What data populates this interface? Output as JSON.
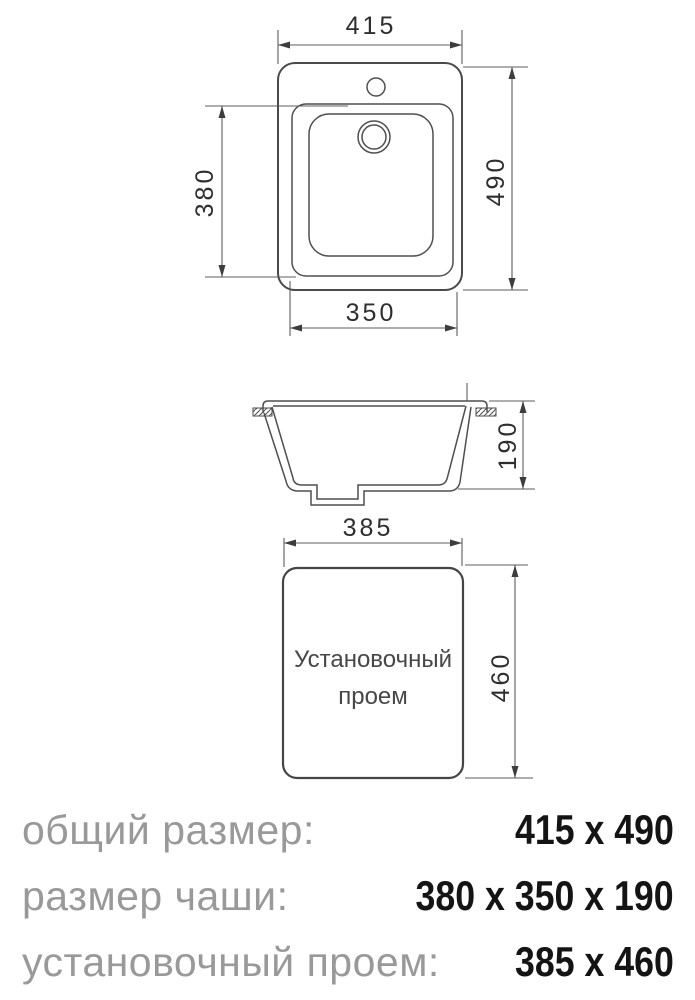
{
  "colors": {
    "background": "#ffffff",
    "drawing_line": "#4a4a4a",
    "dimension_line": "#5c5c5c",
    "dimension_text": "#2e2e2e",
    "caption_text": "#474747",
    "summary_label": "#999999",
    "summary_value": "#141414"
  },
  "top_view": {
    "overall_width": "415",
    "overall_height": "490",
    "bowl_length": "380",
    "bowl_width": "350"
  },
  "section_view": {
    "bowl_depth": "190"
  },
  "cutout_view": {
    "width": "385",
    "height": "460",
    "caption_line1": "Установочный",
    "caption_line2": "проем"
  },
  "summary": {
    "rows": [
      {
        "label": "общий размер:",
        "value": "415 x 490"
      },
      {
        "label": "размер чаши:",
        "value": "380 x 350 x 190"
      },
      {
        "label": "установочный проем:",
        "value": "385 x 460"
      }
    ]
  }
}
